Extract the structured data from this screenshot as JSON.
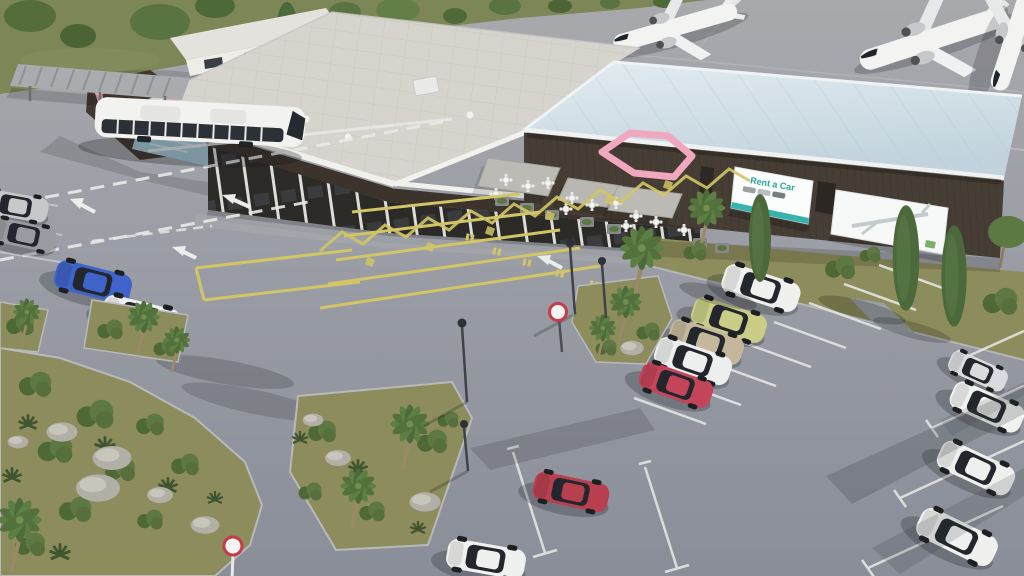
{
  "scene": {
    "setting": "airport-terminal-aerial-3d-render",
    "view": "aerial-oblique"
  },
  "signage": {
    "rent_a_car_billboard": {
      "text": "Rent a Car",
      "text_color": "#2ba39e",
      "stripe_color": "#35b3ac"
    },
    "airline_billboard": {
      "content": "airplane-sketch-graphic"
    },
    "terminal_logo": {
      "type": "wing-emblem"
    },
    "road_sign_front": {
      "type": "red-ring-circle"
    },
    "road_sign_crosswalk": {
      "type": "red-ring-circle-tilted"
    }
  },
  "palette": {
    "asphalt": "#8f939d",
    "apron_line": "#c3c4c7",
    "grass_bank": "#7d8656",
    "island_grass": "#8d8c5c",
    "terminal_roof": "#d6d4cd",
    "hall_roof": "#d5e2e9",
    "facade_dark": "#463d35",
    "accent_pink": "#f0a7bd",
    "accent_teal": "#35b3ac",
    "glass_dark": "#2c2a27",
    "marking_yellow": "#d2c565",
    "marking_white": "#e8e9e8",
    "canopy_gray": "#b9b7b2"
  },
  "aircraft": [
    {
      "id": "airplane-1",
      "color": "#f3f4f2"
    },
    {
      "id": "airplane-2",
      "color": "#f3f4f2"
    },
    {
      "id": "airplane-3",
      "color": "#f3f4f2"
    }
  ],
  "bus": {
    "id": "coach-bus",
    "color": "#f2f3f1"
  },
  "cars": [
    {
      "id": "car-silver-left-1",
      "color": "#c6c8ca"
    },
    {
      "id": "car-gray-left-2",
      "color": "#999ba0"
    },
    {
      "id": "car-blue-sedan",
      "color": "#3f63c8"
    },
    {
      "id": "car-white-suv-left",
      "color": "#eef0ef"
    },
    {
      "id": "car-white-suv-row",
      "color": "#f0f1ef"
    },
    {
      "id": "car-lime-sedan",
      "color": "#c9cd86"
    },
    {
      "id": "car-beige-wagon",
      "color": "#c5b79c"
    },
    {
      "id": "car-white-suv-row-2",
      "color": "#edefee"
    },
    {
      "id": "car-red-hatch-row",
      "color": "#c2455a"
    },
    {
      "id": "car-red-hatch-bottom",
      "color": "#b8404e"
    },
    {
      "id": "car-white-bottom",
      "color": "#f0f1ef"
    },
    {
      "id": "car-silver-right",
      "color": "#d9dbdc"
    },
    {
      "id": "car-white-coupe-right",
      "color": "#f1f2f0"
    },
    {
      "id": "car-white-sedan-right",
      "color": "#eef0ee"
    },
    {
      "id": "car-white-suv-right",
      "color": "#f0f1ef"
    }
  ],
  "vegetation": {
    "palms": 10,
    "cypresses": 3,
    "bushes": 22,
    "lawn_islands": 5
  },
  "furniture": {
    "cafe_tables": 12,
    "canopies": 3,
    "street_lamps": 4,
    "planters": 8
  }
}
